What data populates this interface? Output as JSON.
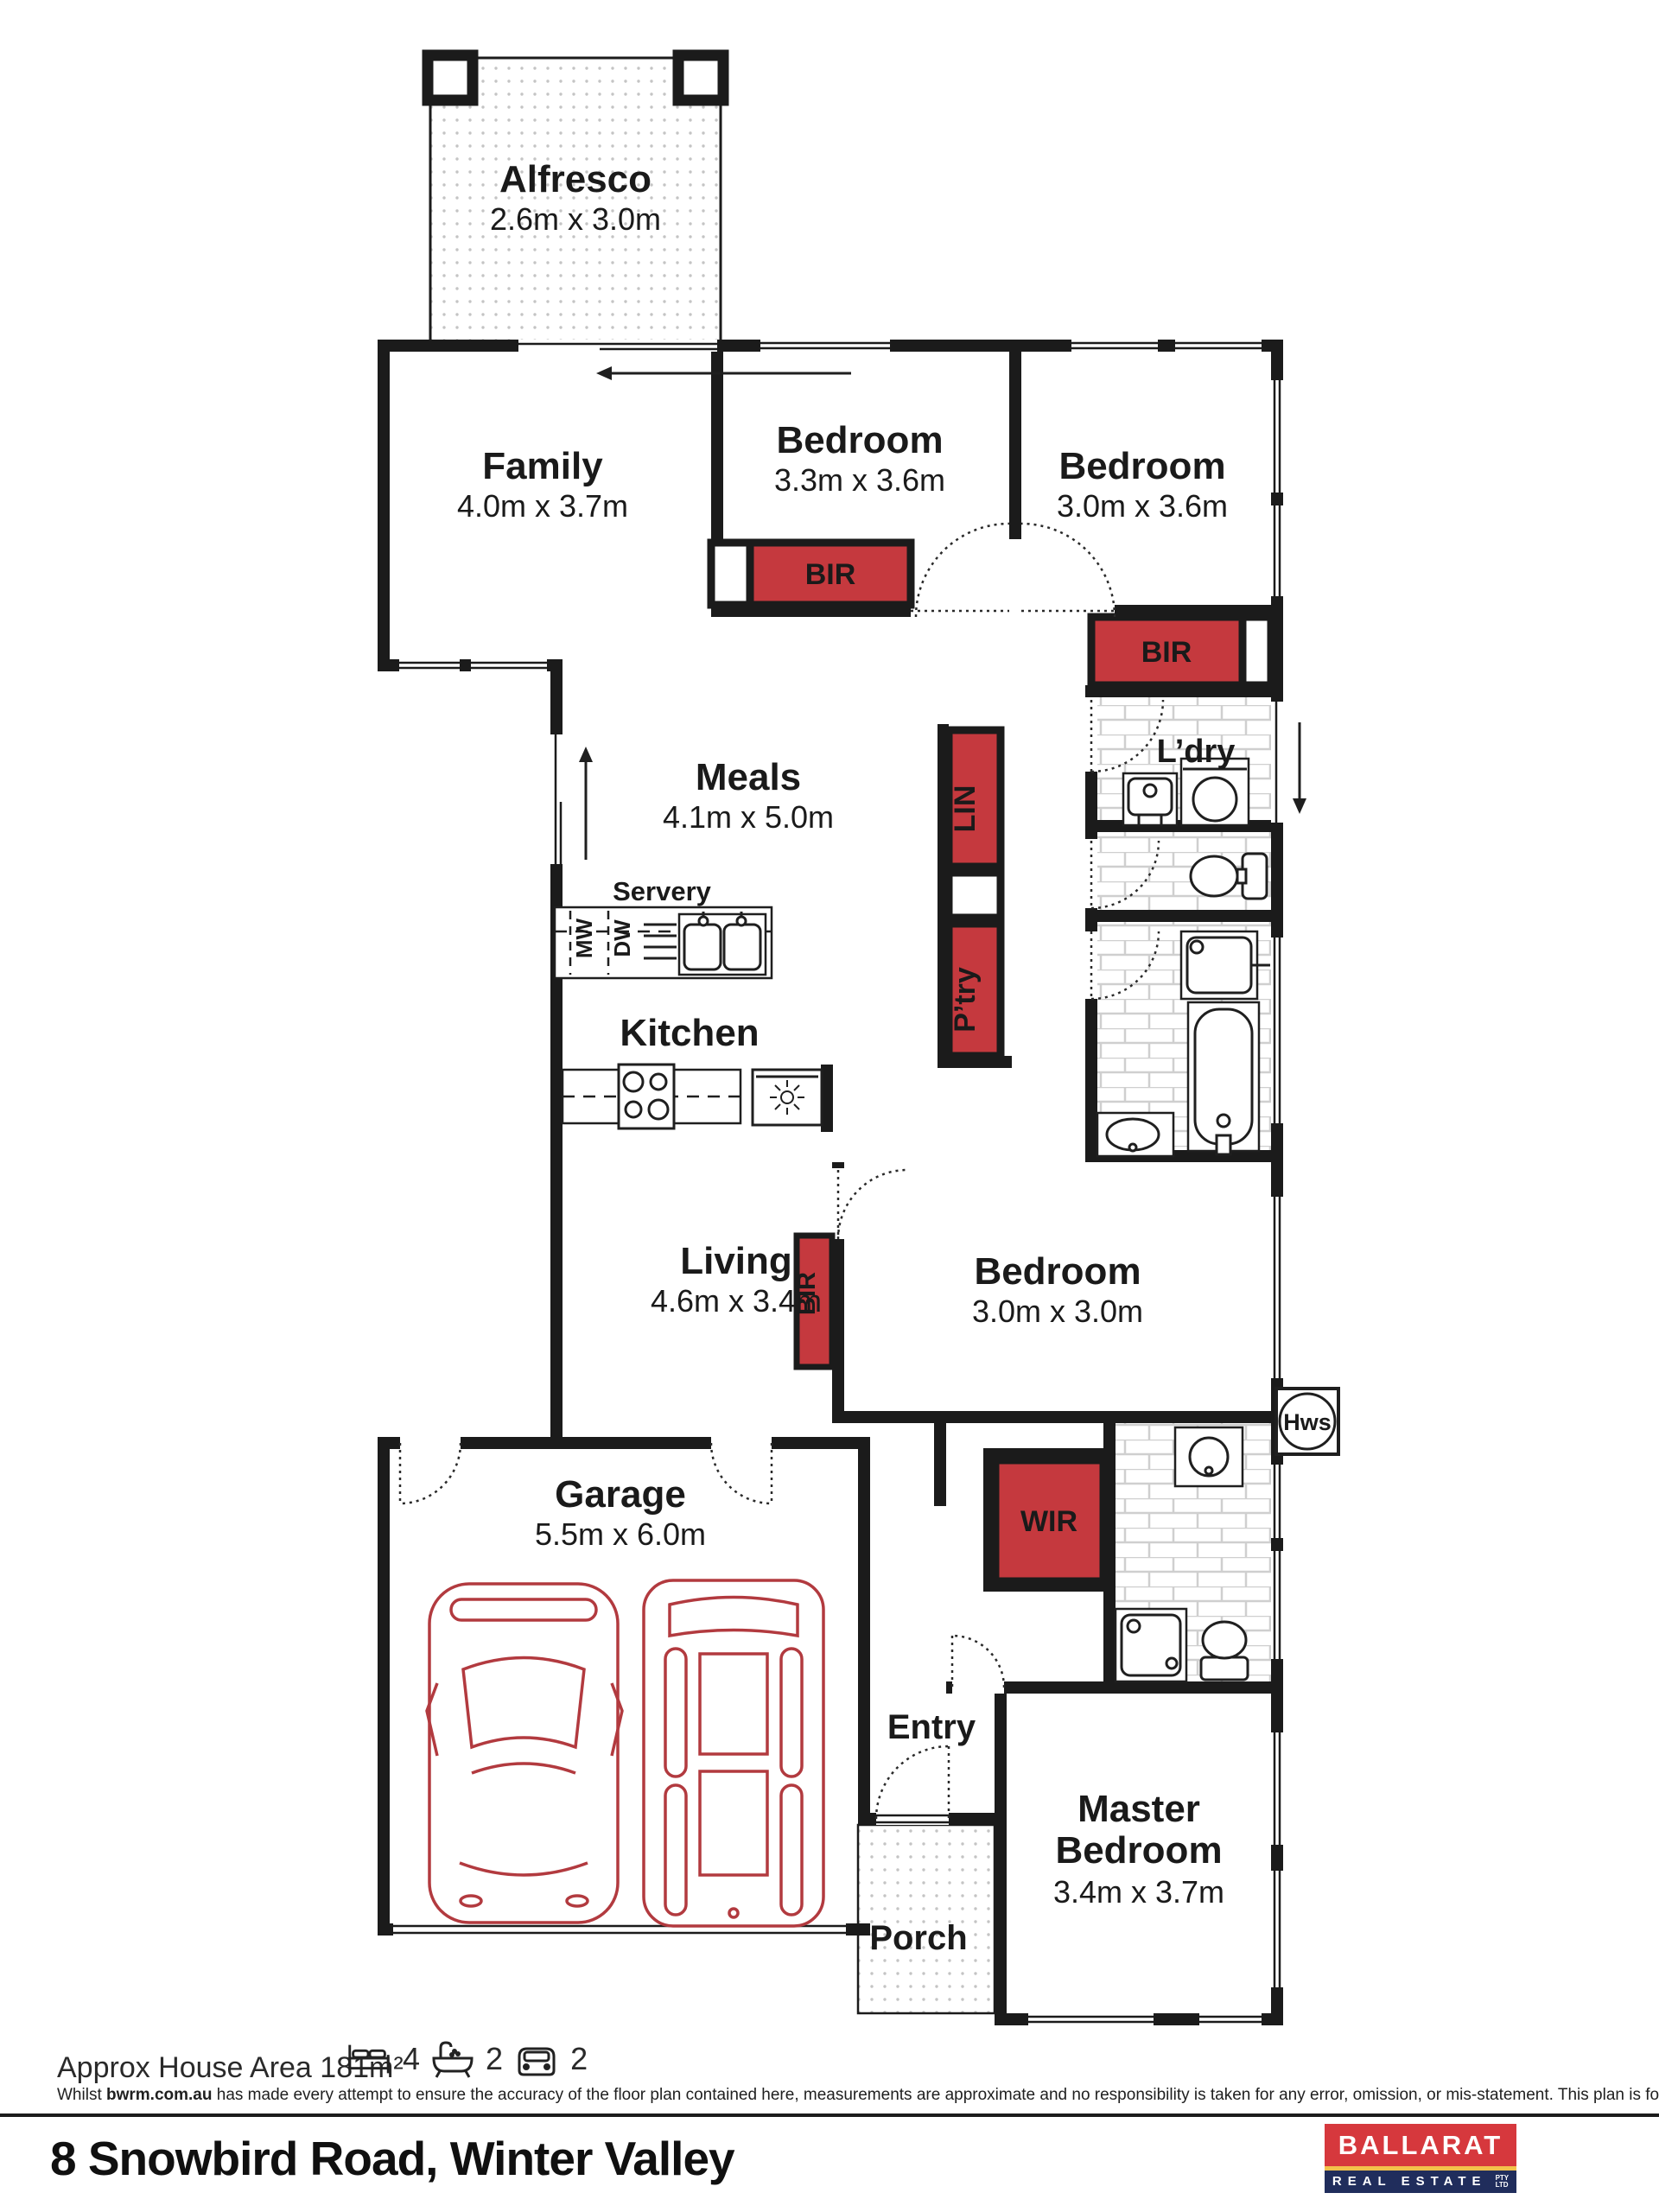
{
  "plan": {
    "rooms": {
      "alfresco": {
        "name": "Alfresco",
        "dims": "2.6m x 3.0m"
      },
      "family": {
        "name": "Family",
        "dims": "4.0m x 3.7m"
      },
      "bedroom2": {
        "name": "Bedroom",
        "dims": "3.3m x 3.6m"
      },
      "bedroom3": {
        "name": "Bedroom",
        "dims": "3.0m x 3.6m"
      },
      "meals": {
        "name": "Meals",
        "dims": "4.1m x 5.0m"
      },
      "servery": {
        "name": "Servery"
      },
      "kitchen": {
        "name": "Kitchen"
      },
      "living": {
        "name": "Living",
        "dims": "4.6m x 3.4m"
      },
      "garage": {
        "name": "Garage",
        "dims": "5.5m x 6.0m"
      },
      "entry": {
        "name": "Entry"
      },
      "porch": {
        "name": "Porch"
      },
      "master": {
        "name_line1": "Master",
        "name_line2": "Bedroom",
        "dims": "3.4m x 3.7m"
      },
      "bedroom4": {
        "name": "Bedroom",
        "dims": "3.0m x 3.0m"
      },
      "laundry": {
        "name": "L’dry"
      }
    },
    "storage": {
      "bir": "BIR",
      "lin": "LIN",
      "pantry": "P’try",
      "wir": "WIR"
    },
    "appliances": {
      "mw": "MW",
      "dw": "DW",
      "hws": "Hws"
    }
  },
  "footer": {
    "area_label": "Approx House Area 181m²",
    "beds": "4",
    "baths": "2",
    "cars": "2",
    "disclaimer_prefix": "Whilst ",
    "disclaimer_bold": "bwrm.com.au",
    "disclaimer_rest": " has made every attempt to ensure the accuracy of the floor plan contained here, measurements are approximate and no responsibility is taken for any error, omission, or mis-statement. This plan is for illustrative purposes only.",
    "address": "8 Snowbird Road, Winter Valley"
  },
  "logo": {
    "line1": "BALLARAT",
    "line2": "REAL ESTATE",
    "suffix_line1": "PTY",
    "suffix_line2": "LTD"
  },
  "colors": {
    "storage_red": "#c5393e",
    "car_red": "#b23a3f",
    "wall_black": "#1b1b1b",
    "logo_red": "#d6383d",
    "logo_navy": "#202d5c",
    "logo_yellow": "#f2c14b"
  }
}
